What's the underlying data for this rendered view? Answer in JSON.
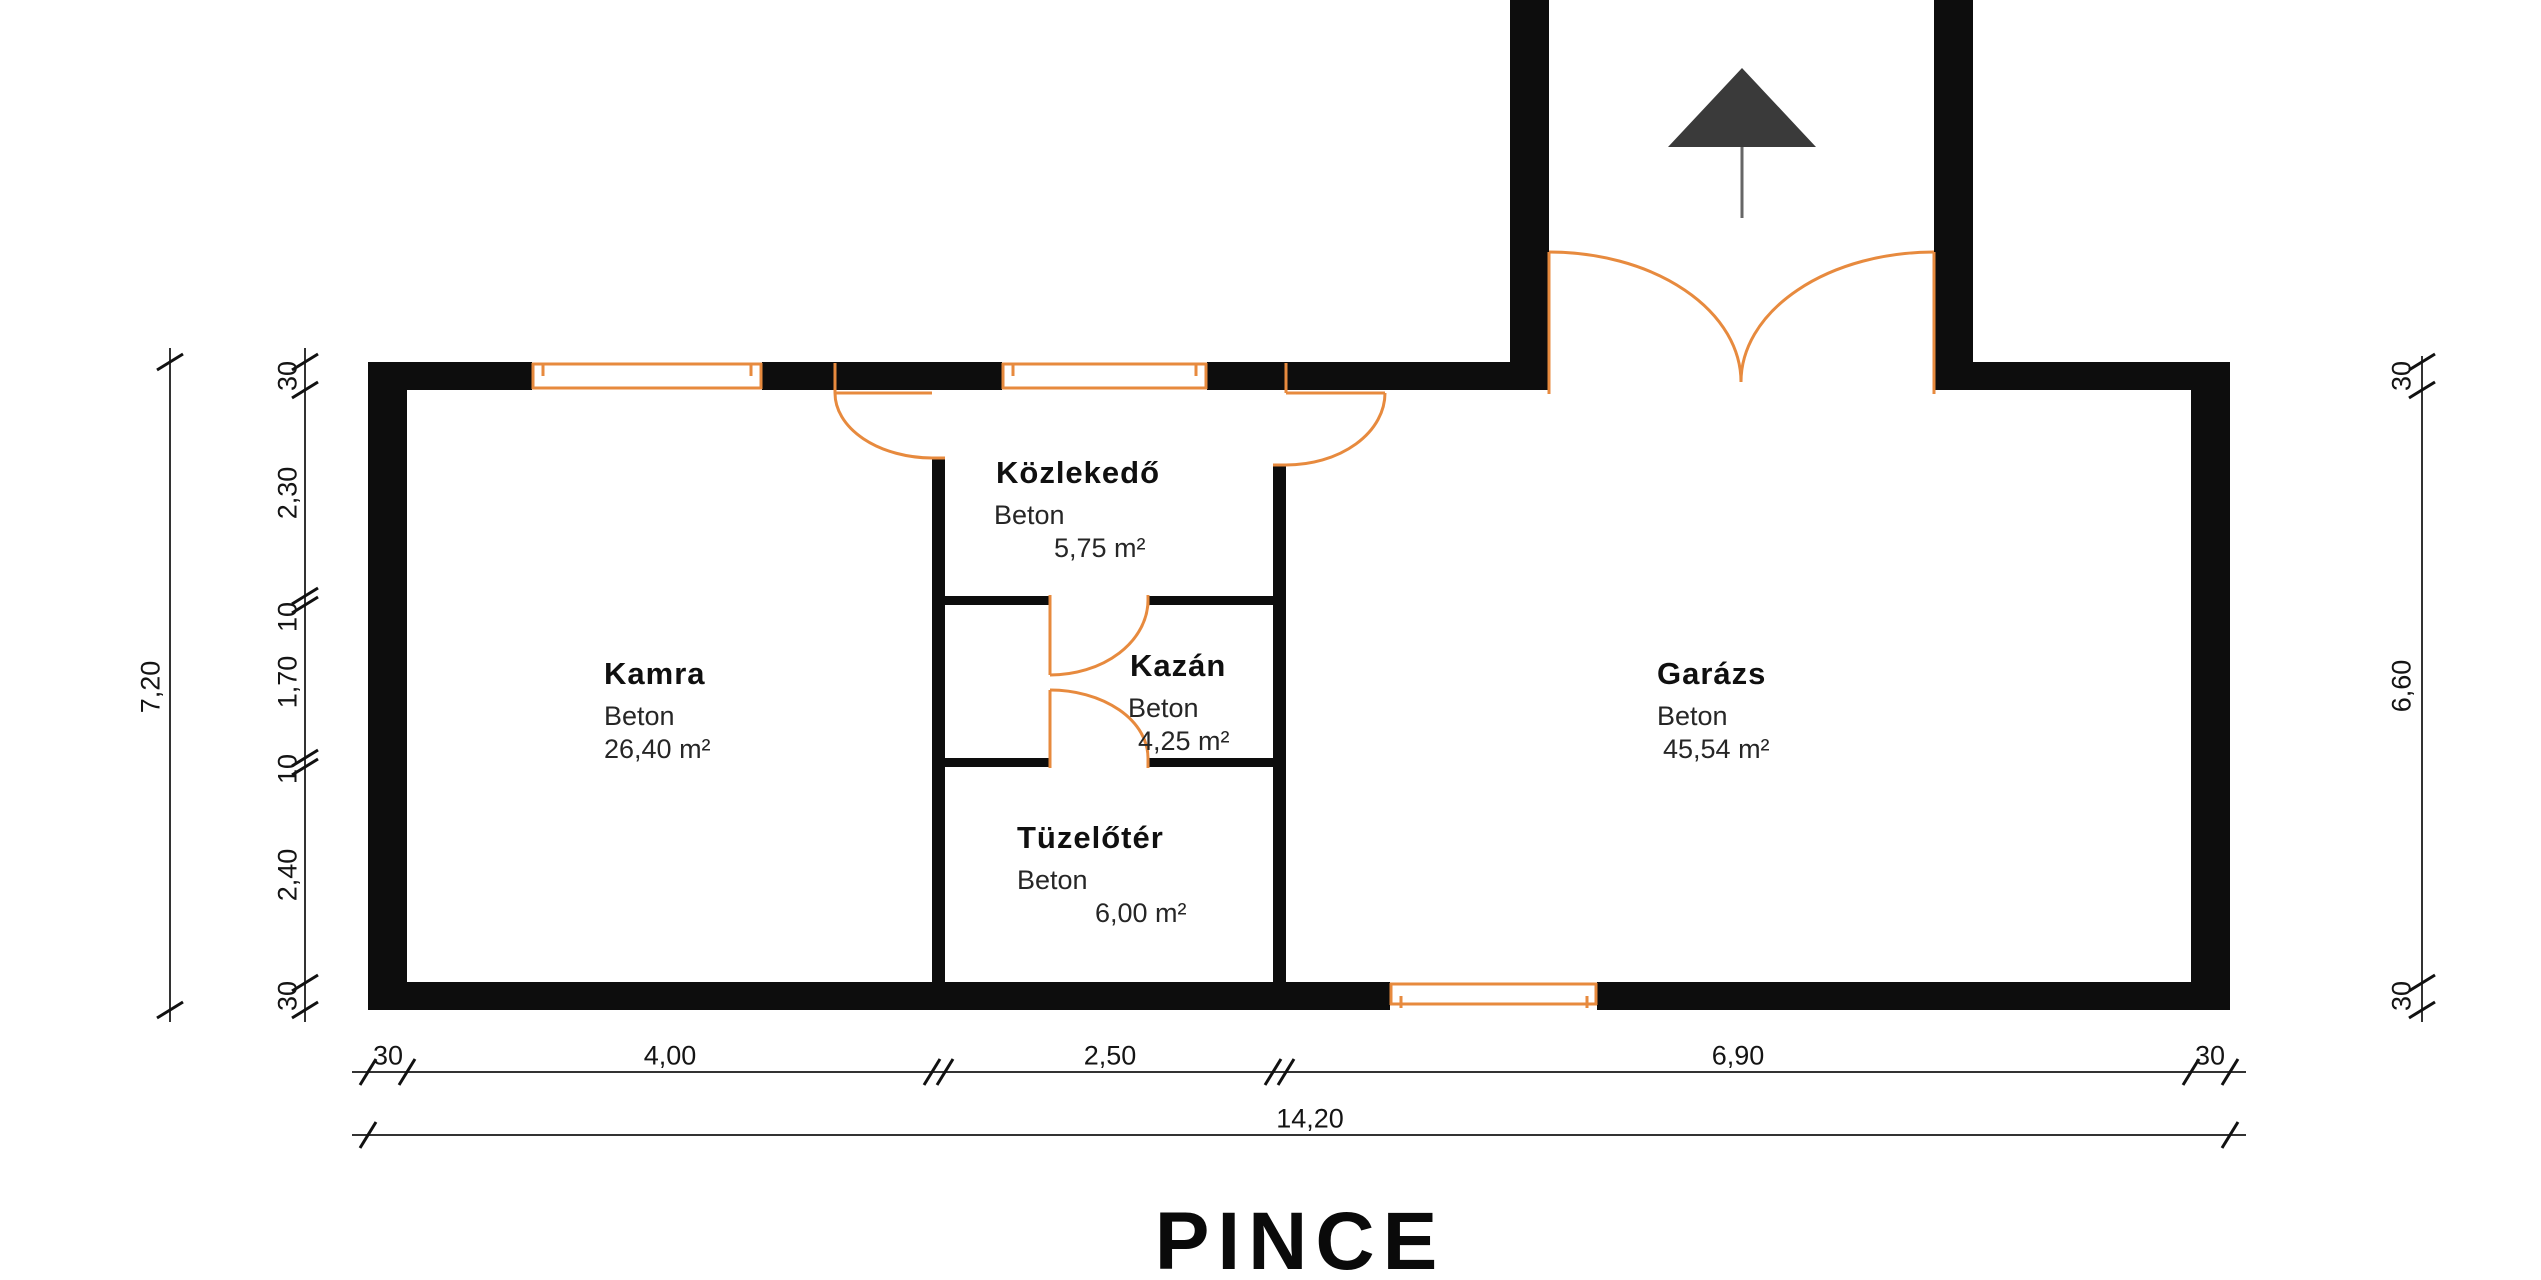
{
  "title": "PINCE",
  "colors": {
    "wall": "#0d0d0d",
    "accent_orange": "#e78a3e",
    "dimension": "#1a1a1a",
    "arrow": "#3a3a3a"
  },
  "rooms": {
    "kamra": {
      "name": "Kamra",
      "material": "Beton",
      "area": "26,40 m²"
    },
    "kozlekedo": {
      "name": "Közlekedő",
      "material": "Beton",
      "area": "5,75 m²"
    },
    "kazan": {
      "name": "Kazán",
      "material": "Beton",
      "area": "4,25 m²"
    },
    "tuzeloter": {
      "name": "Tüzelőtér",
      "material": "Beton",
      "area": "6,00 m²"
    },
    "garazs": {
      "name": "Garázs",
      "material": "Beton",
      "area": "45,54 m²"
    }
  },
  "dimensions": {
    "left_total": "7,20",
    "left_chain": [
      "30",
      "2,30",
      "10",
      "1,70",
      "10",
      "2,40",
      "30"
    ],
    "right_chain": [
      "30",
      "6,60",
      "30"
    ],
    "bottom_chain": [
      "30",
      "4,00",
      "2,50",
      "6,90",
      "30"
    ],
    "bottom_total": "14,20"
  }
}
